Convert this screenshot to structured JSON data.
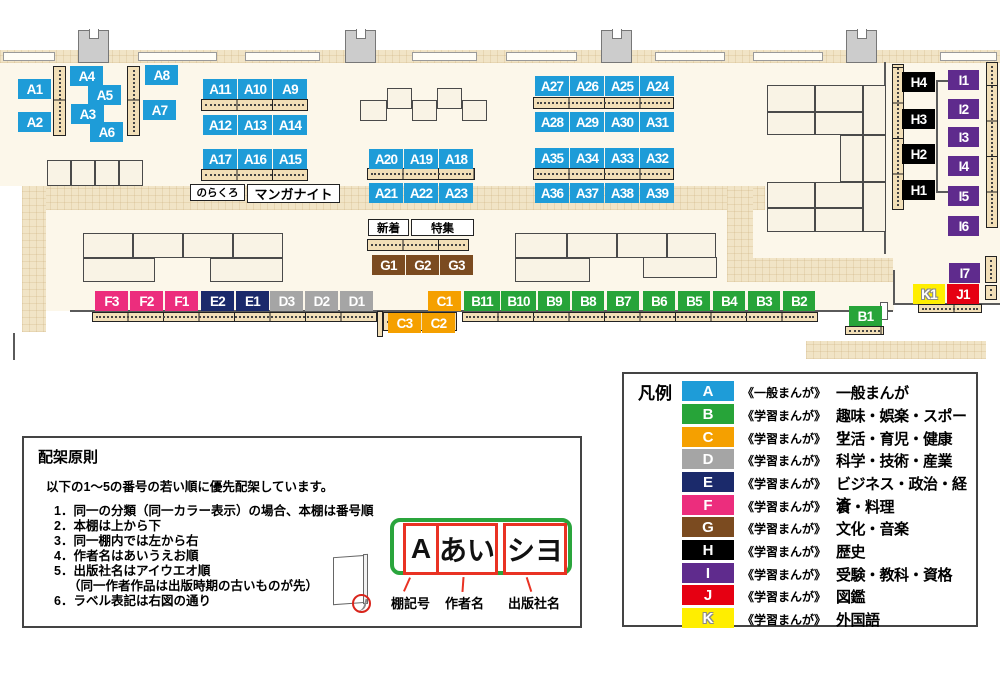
{
  "colors": {
    "A": "#1e9cd8",
    "B": "#27a439",
    "C": "#f5a000",
    "D": "#a5a5a5",
    "E": "#1b2a6b",
    "F": "#ec2d7d",
    "G": "#7b4b20",
    "H": "#000000",
    "I": "#5f2b8d",
    "J": "#e60012",
    "K": "#ffee00"
  },
  "map": {
    "labels": {
      "A1": "A1",
      "A2": "A2",
      "A3": "A3",
      "A4": "A4",
      "A5": "A5",
      "A6": "A6",
      "A7": "A7",
      "A8": "A8",
      "A9": "A9",
      "A10": "A10",
      "A11": "A11",
      "A12": "A12",
      "A13": "A13",
      "A14": "A14",
      "A15": "A15",
      "A16": "A16",
      "A17": "A17",
      "A18": "A18",
      "A19": "A19",
      "A20": "A20",
      "A21": "A21",
      "A22": "A22",
      "A23": "A23",
      "A24": "A24",
      "A25": "A25",
      "A26": "A26",
      "A27": "A27",
      "A28": "A28",
      "A29": "A29",
      "A30": "A30",
      "A31": "A31",
      "A32": "A32",
      "A33": "A33",
      "A34": "A34",
      "A35": "A35",
      "A36": "A36",
      "A37": "A37",
      "A38": "A38",
      "A39": "A39",
      "B1": "B1",
      "B2": "B2",
      "B3": "B3",
      "B4": "B4",
      "B5": "B5",
      "B6": "B6",
      "B7": "B7",
      "B8": "B8",
      "B9": "B9",
      "B10": "B10",
      "B11": "B11",
      "C1": "C1",
      "C2": "C2",
      "C3": "C3",
      "D1": "D1",
      "D2": "D2",
      "D3": "D3",
      "E1": "E1",
      "E2": "E2",
      "F1": "F1",
      "F2": "F2",
      "F3": "F3",
      "G1": "G1",
      "G2": "G2",
      "G3": "G3",
      "H1": "H1",
      "H2": "H2",
      "H3": "H3",
      "H4": "H4",
      "I1": "I1",
      "I2": "I2",
      "I3": "I3",
      "I4": "I4",
      "I5": "I5",
      "I6": "I6",
      "I7": "I7",
      "J1": "J1",
      "K1": "K1"
    },
    "annotations": {
      "norakuro": "のらくろ",
      "manga_night": "マンガナイト",
      "new_arrivals": "新着",
      "feature": "特集"
    }
  },
  "legend": {
    "title": "凡例",
    "items": [
      {
        "code": "A",
        "type": "《一般まんが》",
        "category": "一般まんが"
      },
      {
        "code": "B",
        "type": "《学習まんが》",
        "category": "趣味・娯楽・スポーツ"
      },
      {
        "code": "C",
        "type": "《学習まんが》",
        "category": "生活・育児・健康"
      },
      {
        "code": "D",
        "type": "《学習まんが》",
        "category": "科学・技術・産業"
      },
      {
        "code": "E",
        "type": "《学習まんが》",
        "category": "ビジネス・政治・経済"
      },
      {
        "code": "F",
        "type": "《学習まんが》",
        "category": "食・料理"
      },
      {
        "code": "G",
        "type": "《学習まんが》",
        "category": "文化・音楽"
      },
      {
        "code": "H",
        "type": "《学習まんが》",
        "category": "歴史"
      },
      {
        "code": "I",
        "type": "《学習まんが》",
        "category": "受験・教科・資格"
      },
      {
        "code": "J",
        "type": "《学習まんが》",
        "category": "図鑑"
      },
      {
        "code": "K",
        "type": "《学習まんが》",
        "category": "外国語"
      }
    ]
  },
  "principles": {
    "title": "配架原則",
    "intro": "以下の1～5の番号の若い順に優先配架しています。",
    "rules": [
      "1．同一の分類（同一カラー表示）の場合、本棚は番号順",
      "2．本棚は上から下",
      "3．同一棚内では左から右",
      "4．作者名はあいうえお順",
      "5．出版社名はアイウエオ順",
      "（同一作者作品は出版時期の古いものが先）",
      "6．ラベル表記は右図の通り"
    ],
    "label_diagram": {
      "segments": [
        "A",
        "あい",
        "シヨ"
      ],
      "captions": [
        "棚記号",
        "作者名",
        "出版社名"
      ]
    }
  }
}
